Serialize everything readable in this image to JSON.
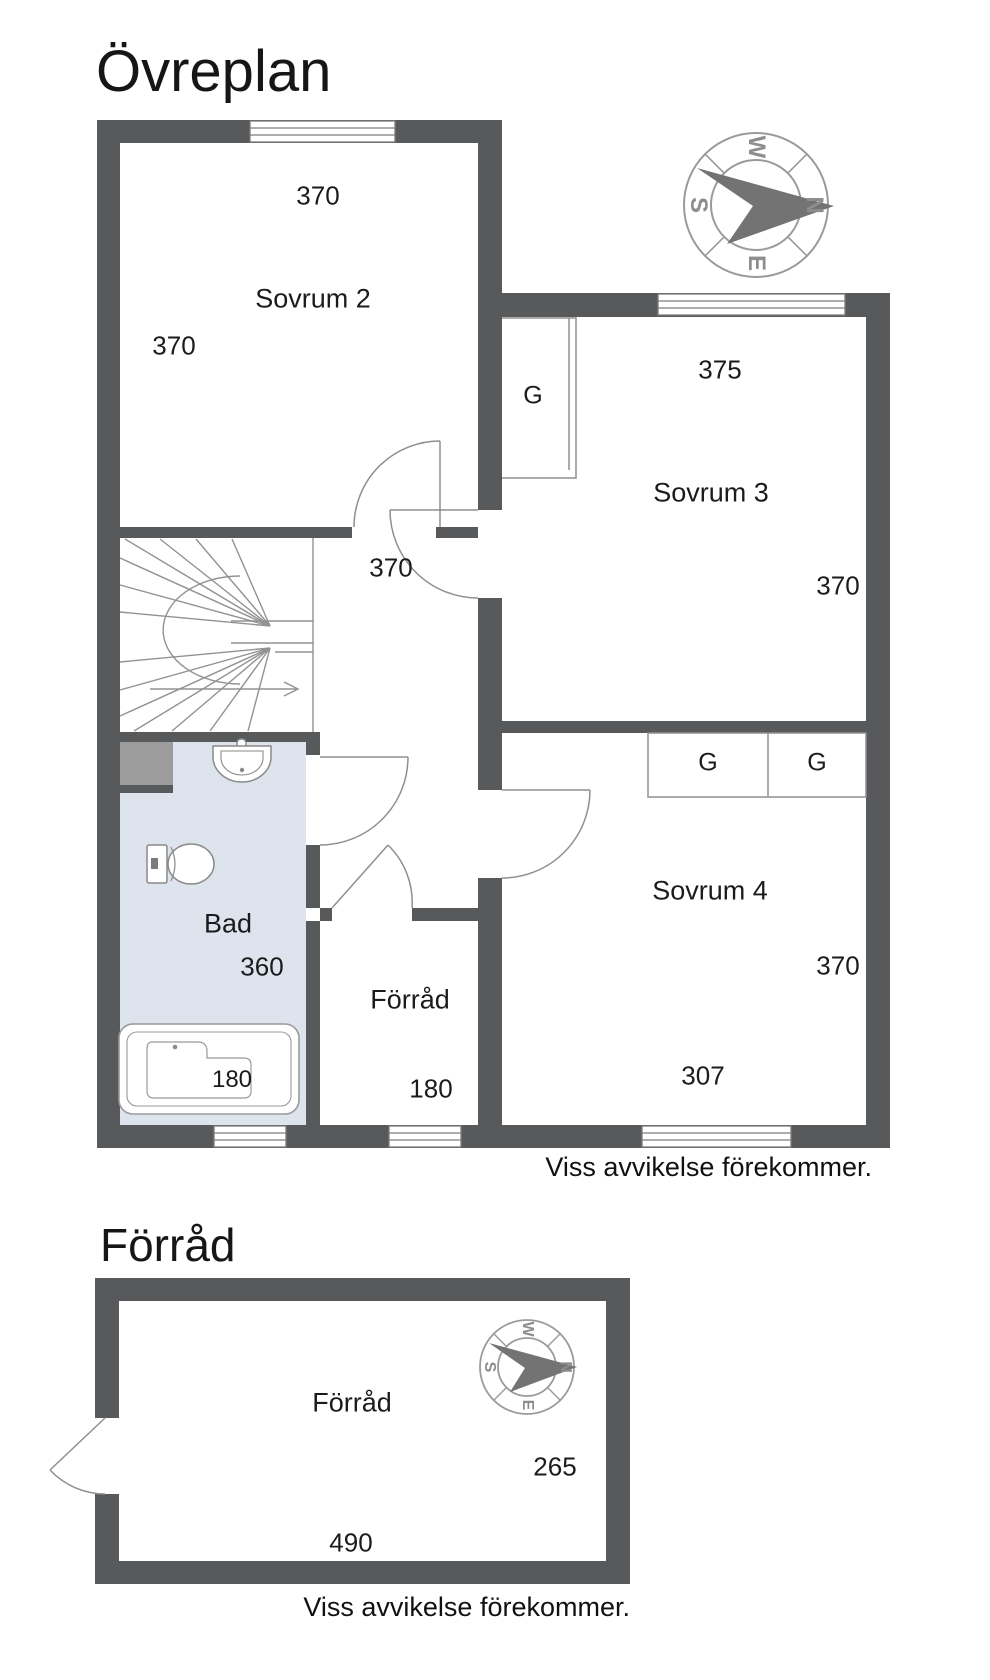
{
  "header": {
    "title": "Övreplan"
  },
  "upper_plan": {
    "compass": {
      "w": "W",
      "n": "N",
      "e": "E",
      "s": "S"
    },
    "rooms": {
      "sovrum2": {
        "label": "Sovrum 2",
        "dim_top": "370",
        "dim_left": "370"
      },
      "sovrum3": {
        "label": "Sovrum 3",
        "dim_top": "375",
        "dim_right": "370",
        "closet_label": "G"
      },
      "sovrum4": {
        "label": "Sovrum 4",
        "dim_right": "370",
        "dim_bottom": "307",
        "closet_left_label": "G",
        "closet_right_label": "G"
      },
      "hall": {
        "dim": "370"
      },
      "bad": {
        "label": "Bad",
        "dim": "360",
        "bathtub_dim": "180"
      },
      "forrad": {
        "label": "Förråd",
        "dim": "180"
      }
    },
    "disclaimer": "Viss avvikelse förekommer."
  },
  "lower_plan": {
    "title": "Förråd",
    "compass": {
      "w": "W",
      "n": "N",
      "e": "E",
      "s": "S"
    },
    "room": {
      "label": "Förråd",
      "dim_width": "490",
      "dim_height": "265"
    },
    "disclaimer": "Viss avvikelse förekommer."
  },
  "colors": {
    "wall": "#58595b",
    "bath_floor": "#dde4ee",
    "shaft": "#9c9c9c",
    "line": "#8f8f8f",
    "text": "#1b1b1b"
  }
}
